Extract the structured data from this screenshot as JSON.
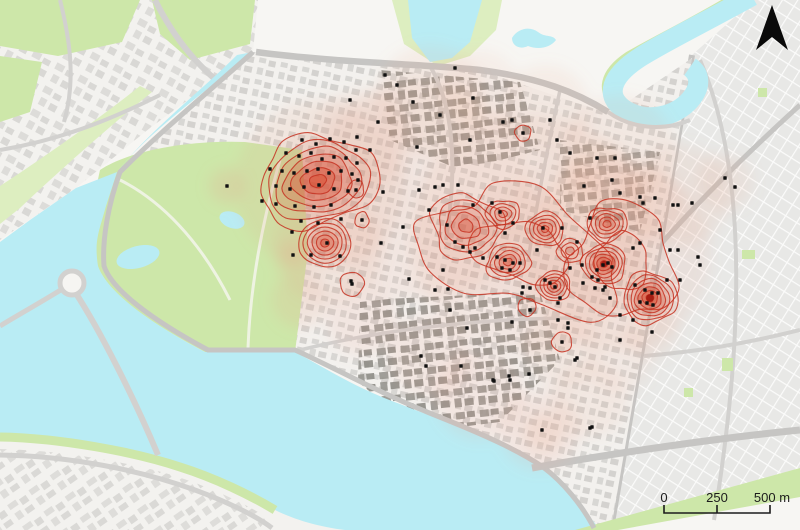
{
  "map": {
    "kind": "kernel-density hotspot map over city basemap",
    "scale_bar": {
      "labels": [
        "0",
        "250",
        "500 m"
      ]
    },
    "north_arrow": "north"
  },
  "colors": {
    "background": "#f7f6f3",
    "water": "#b9ecf4",
    "park": "#cde7a9",
    "park_light": "#ddeec0",
    "road": "#d2d1cf",
    "road_major": "#c6c5c3",
    "building_light": "#dbdad7",
    "building_mid": "#bdbcb9",
    "building_dark": "#96958f",
    "grid_block": "#e8e8e6",
    "heat_low": "#e7a68c",
    "heat_fill": "#d8482c",
    "heat_stroke": "#c63322",
    "heat_core": "#9c130a",
    "point": "#111111",
    "scalebar_text": "#1c1c1c",
    "north_arrow": "#0a0a0a"
  },
  "heat": {
    "blobs": [
      [
        420,
        190,
        110,
        0.13
      ],
      [
        530,
        235,
        120,
        0.13
      ],
      [
        615,
        255,
        95,
        0.13
      ],
      [
        320,
        185,
        85,
        0.15
      ],
      [
        328,
        248,
        55,
        0.15
      ],
      [
        430,
        100,
        55,
        0.12
      ],
      [
        545,
        110,
        45,
        0.12
      ],
      [
        620,
        150,
        55,
        0.12
      ],
      [
        680,
        195,
        50,
        0.12
      ],
      [
        480,
        90,
        40,
        0.1
      ],
      [
        360,
        140,
        50,
        0.12
      ],
      [
        300,
        300,
        28,
        0.18
      ],
      [
        362,
        320,
        36,
        0.14
      ],
      [
        430,
        355,
        42,
        0.14
      ],
      [
        480,
        395,
        45,
        0.14
      ],
      [
        540,
        430,
        40,
        0.14
      ],
      [
        590,
        400,
        38,
        0.12
      ],
      [
        560,
        350,
        38,
        0.12
      ],
      [
        620,
        360,
        32,
        0.1
      ],
      [
        650,
        330,
        28,
        0.12
      ],
      [
        543,
        432,
        20,
        0.18
      ],
      [
        227,
        186,
        18,
        0.22
      ],
      [
        293,
        255,
        15,
        0.25
      ],
      [
        725,
        182,
        28,
        0.12
      ],
      [
        648,
        205,
        35,
        0.12
      ],
      [
        600,
        180,
        40,
        0.1
      ],
      [
        560,
        200,
        45,
        0.1
      ]
    ],
    "hotspots": [
      {
        "cx": 318,
        "cy": 181,
        "rx": 60,
        "ry": 45,
        "rot": -12,
        "rings": 7,
        "core": 0.85,
        "wob": 0.16,
        "seed": 3
      },
      {
        "cx": 356,
        "cy": 189,
        "rx": 8,
        "ry": 9,
        "rot": 0,
        "rings": 1,
        "core": 0,
        "wob": 0.1,
        "seed": 5
      },
      {
        "cx": 362,
        "cy": 220,
        "rx": 7,
        "ry": 8,
        "rot": 0,
        "rings": 1,
        "core": 0,
        "wob": 0.1,
        "seed": 6
      },
      {
        "cx": 325,
        "cy": 243,
        "rx": 26,
        "ry": 24,
        "rot": 0,
        "rings": 6,
        "core": 0.6,
        "wob": 0.05,
        "seed": 8
      },
      {
        "cx": 352,
        "cy": 284,
        "rx": 12,
        "ry": 12,
        "rot": 0,
        "rings": 1,
        "core": 0,
        "wob": 0.08,
        "seed": 9
      },
      {
        "cx": 523,
        "cy": 133,
        "rx": 8,
        "ry": 8,
        "rot": 0,
        "rings": 1,
        "core": 0,
        "wob": 0.1,
        "seed": 10
      },
      {
        "cx": 520,
        "cy": 252,
        "rx": 102,
        "ry": 56,
        "rot": 16,
        "rings": 2,
        "core": 0,
        "wob": 0.28,
        "seed": 12
      },
      {
        "cx": 466,
        "cy": 226,
        "rx": 36,
        "ry": 32,
        "rot": 20,
        "rings": 5,
        "core": 0.5,
        "wob": 0.18,
        "seed": 13
      },
      {
        "cx": 503,
        "cy": 214,
        "rx": 17,
        "ry": 14,
        "rot": 0,
        "rings": 4,
        "core": 0.35,
        "wob": 0.12,
        "seed": 14
      },
      {
        "cx": 545,
        "cy": 229,
        "rx": 19,
        "ry": 17,
        "rot": 0,
        "rings": 5,
        "core": 0.5,
        "wob": 0.1,
        "seed": 15
      },
      {
        "cx": 508,
        "cy": 262,
        "rx": 22,
        "ry": 18,
        "rot": -15,
        "rings": 5,
        "core": 0.6,
        "wob": 0.12,
        "seed": 16
      },
      {
        "cx": 570,
        "cy": 251,
        "rx": 13,
        "ry": 12,
        "rot": 0,
        "rings": 3,
        "core": 0.3,
        "wob": 0.1,
        "seed": 17
      },
      {
        "cx": 622,
        "cy": 262,
        "rx": 52,
        "ry": 58,
        "rot": 0,
        "rings": 2,
        "core": 0,
        "wob": 0.22,
        "seed": 18
      },
      {
        "cx": 607,
        "cy": 224,
        "rx": 20,
        "ry": 17,
        "rot": 0,
        "rings": 5,
        "core": 0.55,
        "wob": 0.12,
        "seed": 19
      },
      {
        "cx": 604,
        "cy": 264,
        "rx": 22,
        "ry": 20,
        "rot": 0,
        "rings": 6,
        "core": 1,
        "wob": 0.1,
        "seed": 20
      },
      {
        "cx": 554,
        "cy": 286,
        "rx": 17,
        "ry": 15,
        "rot": 0,
        "rings": 5,
        "core": 0.5,
        "wob": 0.1,
        "seed": 21
      },
      {
        "cx": 527,
        "cy": 307,
        "rx": 9,
        "ry": 9,
        "rot": 0,
        "rings": 1,
        "core": 0,
        "wob": 0.08,
        "seed": 22
      },
      {
        "cx": 650,
        "cy": 298,
        "rx": 27,
        "ry": 26,
        "rot": 8,
        "rings": 7,
        "core": 1,
        "wob": 0.12,
        "seed": 23
      },
      {
        "cx": 562,
        "cy": 342,
        "rx": 10,
        "ry": 10,
        "rot": 0,
        "rings": 1,
        "core": 0,
        "wob": 0.08,
        "seed": 24
      }
    ]
  },
  "points": [
    [
      302,
      140
    ],
    [
      316,
      144
    ],
    [
      330,
      139
    ],
    [
      344,
      142
    ],
    [
      356,
      150
    ],
    [
      286,
      153
    ],
    [
      299,
      156
    ],
    [
      311,
      153
    ],
    [
      322,
      159
    ],
    [
      334,
      157
    ],
    [
      346,
      158
    ],
    [
      357,
      163
    ],
    [
      270,
      169
    ],
    [
      282,
      171
    ],
    [
      294,
      173
    ],
    [
      307,
      171
    ],
    [
      318,
      169
    ],
    [
      329,
      173
    ],
    [
      341,
      171
    ],
    [
      352,
      174
    ],
    [
      276,
      186
    ],
    [
      290,
      189
    ],
    [
      304,
      187
    ],
    [
      319,
      185
    ],
    [
      334,
      189
    ],
    [
      348,
      191
    ],
    [
      262,
      201
    ],
    [
      276,
      204
    ],
    [
      295,
      206
    ],
    [
      314,
      207
    ],
    [
      331,
      205
    ],
    [
      301,
      221
    ],
    [
      318,
      223
    ],
    [
      341,
      219
    ],
    [
      292,
      232
    ],
    [
      327,
      243
    ],
    [
      340,
      256
    ],
    [
      311,
      255
    ],
    [
      352,
      284
    ],
    [
      356,
      190
    ],
    [
      362,
      220
    ],
    [
      293,
      255
    ],
    [
      227,
      186
    ],
    [
      385,
      75
    ],
    [
      350,
      100
    ],
    [
      378,
      122
    ],
    [
      413,
      102
    ],
    [
      440,
      115
    ],
    [
      473,
      98
    ],
    [
      503,
      122
    ],
    [
      523,
      133
    ],
    [
      512,
      120
    ],
    [
      550,
      120
    ],
    [
      557,
      140
    ],
    [
      470,
      140
    ],
    [
      417,
      147
    ],
    [
      370,
      150
    ],
    [
      357,
      137
    ],
    [
      397,
      85
    ],
    [
      455,
      68
    ],
    [
      570,
      153
    ],
    [
      597,
      158
    ],
    [
      615,
      158
    ],
    [
      640,
      197
    ],
    [
      655,
      198
    ],
    [
      678,
      205
    ],
    [
      725,
      178
    ],
    [
      735,
      187
    ],
    [
      620,
      193
    ],
    [
      590,
      218
    ],
    [
      643,
      203
    ],
    [
      692,
      203
    ],
    [
      673,
      205
    ],
    [
      698,
      257
    ],
    [
      678,
      250
    ],
    [
      660,
      230
    ],
    [
      612,
      180
    ],
    [
      584,
      186
    ],
    [
      435,
      187
    ],
    [
      458,
      185
    ],
    [
      473,
      205
    ],
    [
      492,
      203
    ],
    [
      500,
      212
    ],
    [
      513,
      223
    ],
    [
      543,
      228
    ],
    [
      562,
      228
    ],
    [
      577,
      242
    ],
    [
      455,
      242
    ],
    [
      463,
      247
    ],
    [
      470,
      252
    ],
    [
      475,
      248
    ],
    [
      483,
      258
    ],
    [
      497,
      257
    ],
    [
      505,
      260
    ],
    [
      513,
      263
    ],
    [
      520,
      263
    ],
    [
      502,
      268
    ],
    [
      510,
      270
    ],
    [
      523,
      287
    ],
    [
      530,
      288
    ],
    [
      545,
      280
    ],
    [
      550,
      283
    ],
    [
      555,
      287
    ],
    [
      560,
      298
    ],
    [
      570,
      268
    ],
    [
      582,
      265
    ],
    [
      597,
      270
    ],
    [
      603,
      265
    ],
    [
      612,
      267
    ],
    [
      592,
      277
    ],
    [
      583,
      283
    ],
    [
      595,
      288
    ],
    [
      603,
      290
    ],
    [
      443,
      270
    ],
    [
      435,
      290
    ],
    [
      450,
      310
    ],
    [
      467,
      328
    ],
    [
      530,
      310
    ],
    [
      512,
      322
    ],
    [
      558,
      320
    ],
    [
      568,
      328
    ],
    [
      505,
      233
    ],
    [
      537,
      250
    ],
    [
      447,
      225
    ],
    [
      358,
      180
    ],
    [
      383,
      192
    ],
    [
      403,
      227
    ],
    [
      381,
      243
    ],
    [
      429,
      210
    ],
    [
      419,
      190
    ],
    [
      443,
      185
    ],
    [
      608,
      263
    ],
    [
      635,
      285
    ],
    [
      645,
      290
    ],
    [
      652,
      293
    ],
    [
      658,
      293
    ],
    [
      640,
      302
    ],
    [
      647,
      303
    ],
    [
      653,
      305
    ],
    [
      633,
      320
    ],
    [
      620,
      315
    ],
    [
      610,
      298
    ],
    [
      598,
      280
    ],
    [
      605,
      287
    ],
    [
      667,
      280
    ],
    [
      680,
      280
    ],
    [
      700,
      265
    ],
    [
      633,
      248
    ],
    [
      640,
      243
    ],
    [
      670,
      250
    ],
    [
      620,
      340
    ],
    [
      652,
      332
    ],
    [
      522,
      293
    ],
    [
      558,
      303
    ],
    [
      568,
      323
    ],
    [
      562,
      342
    ],
    [
      577,
      358
    ],
    [
      493,
      380
    ],
    [
      510,
      380
    ],
    [
      590,
      428
    ],
    [
      542,
      430
    ],
    [
      575,
      360
    ],
    [
      592,
      427
    ],
    [
      351,
      281
    ],
    [
      409,
      279
    ],
    [
      448,
      289
    ],
    [
      421,
      356
    ],
    [
      426,
      366
    ],
    [
      461,
      366
    ],
    [
      494,
      381
    ],
    [
      509,
      376
    ],
    [
      529,
      374
    ]
  ]
}
